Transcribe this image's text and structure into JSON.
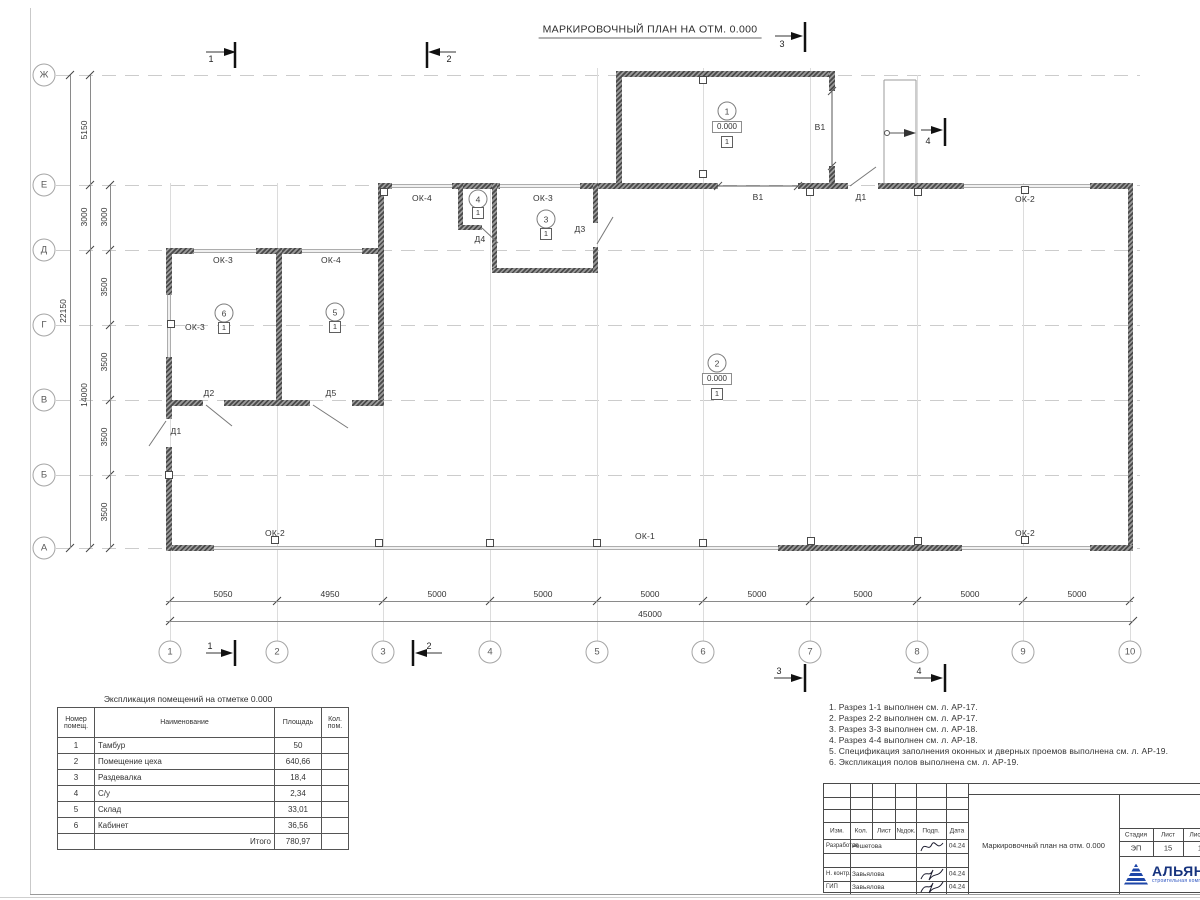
{
  "sheet": {
    "title": "МАРКИРОВОЧНЫЙ ПЛАН НА ОТМ. 0.000"
  },
  "axes": {
    "rows": [
      "Ж",
      "Е",
      "Д",
      "Г",
      "В",
      "Б",
      "А"
    ],
    "cols": [
      "1",
      "2",
      "3",
      "4",
      "5",
      "6",
      "7",
      "8",
      "9",
      "10"
    ]
  },
  "dims": {
    "col_spans": [
      "5050",
      "4950",
      "5000",
      "5000",
      "5000",
      "5000",
      "5000",
      "5000",
      "5000"
    ],
    "total_width": "45000",
    "total_height": "22150",
    "row_outer": [
      "5150",
      "3000",
      "14000"
    ],
    "row_inner": [
      "3000",
      "3500",
      "3500",
      "3500",
      "3500"
    ]
  },
  "marks": {
    "sections": [
      "1",
      "2",
      "3",
      "4"
    ],
    "elev": "0.000",
    "floor_type": "1"
  },
  "rooms": [
    {
      "num": "1"
    },
    {
      "num": "2"
    },
    {
      "num": "3"
    },
    {
      "num": "4"
    },
    {
      "num": "5"
    },
    {
      "num": "6"
    }
  ],
  "openings": {
    "ok1": "ОК-1",
    "ok2": "ОК-2",
    "ok3": "ОК-3",
    "ok4": "ОК-4",
    "v1": "В1",
    "d1": "Д1",
    "d2": "Д2",
    "d3": "Д3",
    "d4": "Д4",
    "d5": "Д5"
  },
  "legend": {
    "title": "Экспликация помещений на отметке 0.000",
    "headers": [
      "Номер помещ.",
      "Наименование",
      "Площадь",
      "Кол. пом."
    ],
    "rows": [
      [
        "1",
        "Тамбур",
        "50"
      ],
      [
        "2",
        "Помещение цеха",
        "640,66"
      ],
      [
        "3",
        "Раздевалка",
        "18,4"
      ],
      [
        "4",
        "С/у",
        "2,34"
      ],
      [
        "5",
        "Склад",
        "33,01"
      ],
      [
        "6",
        "Кабинет",
        "36,56"
      ]
    ],
    "total_label": "Итого",
    "total": "780,97"
  },
  "notes": [
    "1. Разрез 1-1 выполнен см. л. АР-17.",
    "2. Разрез 2-2 выполнен см. л. АР-17.",
    "3. Разрез 3-3 выполнен см. л. АР-18.",
    "4. Разрез 4-4 выполнен см. л. АР-18.",
    "5. Спецификация заполнения оконных и дверных проемов выполнена см. л. АР-19.",
    "6. Экспликация полов выполнена см. л. АР-19."
  ],
  "titleblock": {
    "cols": [
      "Изм.",
      "Кол.",
      "Лист",
      "№док.",
      "Подп.",
      "Дата"
    ],
    "rows": [
      {
        "role": "Разработал",
        "name": "Решетова",
        "date": "04.24"
      },
      {
        "role": "Н. контр.",
        "name": "Завьялова",
        "date": "04.24"
      },
      {
        "role": "ГИП",
        "name": "Завьялова",
        "date": "04.24"
      }
    ],
    "doc_title": "Маркировочный план на отм. 0.000",
    "stage_label": "Стадия",
    "sheet_label": "Лист",
    "sheets_label": "Листов",
    "stage": "ЭП",
    "sheet_num": "15",
    "sheets_total": "1",
    "logo_name": "АЛЬЯНС",
    "logo_sub": "строительная компания"
  }
}
